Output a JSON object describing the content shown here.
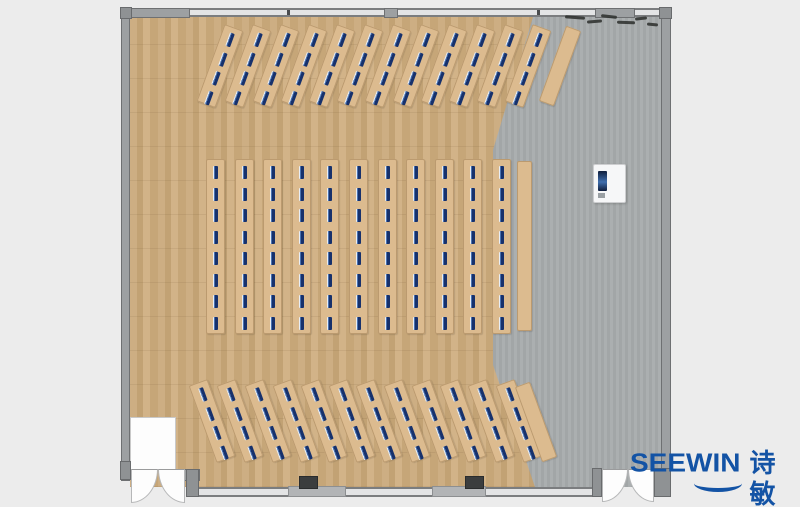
{
  "page": {
    "background": "#ececec"
  },
  "branding": {
    "logo_latin": "SEEWIN",
    "logo_cjk": "诗敏",
    "logo_color": "#1353a5"
  },
  "palette": {
    "wood_floor": "#c9a97e",
    "concrete_floor": "#a7abac",
    "wall": "#9da0a2",
    "desk": "#dcbb8f",
    "monitor_dark": "#17316c",
    "monitor_mid": "#4a72b0",
    "monitor_light": "#e9eef5",
    "pillar": "#3b3d3e"
  },
  "room": {
    "type": "classroom-floor-plan",
    "desk_groups": [
      {
        "name": "desk-group-front",
        "orientation": "angled-right",
        "angle_deg": 20,
        "bench_count": 12,
        "monitors_per_bench": 4,
        "bench": {
          "start_x": 210,
          "pitch": 28,
          "top": 25,
          "w": 20,
          "h": 82
        },
        "monitors": {
          "start": 6,
          "pitch": 20.5,
          "h": 14
        },
        "plain_bench": {
          "x": 552,
          "y": 26,
          "w": 16,
          "h": 80
        }
      },
      {
        "name": "desk-group-middle",
        "orientation": "vertical",
        "angle_deg": 0,
        "bench_count": 11,
        "monitors_per_bench": 8,
        "bench": {
          "start_x": 206,
          "pitch": 28.6,
          "top": 159,
          "w": 19,
          "h": 175
        },
        "monitors": {
          "start": 7,
          "pitch": 21.5,
          "h": 13
        },
        "plain_bench": {
          "x": 517,
          "y": 161,
          "w": 15,
          "h": 170
        }
      },
      {
        "name": "desk-group-back",
        "orientation": "angled-left",
        "angle_deg": -20,
        "bench_count": 12,
        "monitors_per_bench": 4,
        "bench": {
          "start_x": 202,
          "pitch": 27.9,
          "top": 380,
          "w": 20,
          "h": 82
        },
        "monitors": {
          "start": 6,
          "pitch": 20.5,
          "h": 14
        },
        "plain_bench": {
          "x": 528,
          "y": 382,
          "w": 16,
          "h": 80
        }
      }
    ],
    "podium_present": true,
    "doors": {
      "bottom_left": "double-swing",
      "bottom_right": "double-swing"
    },
    "window_pillar_count": 2
  }
}
